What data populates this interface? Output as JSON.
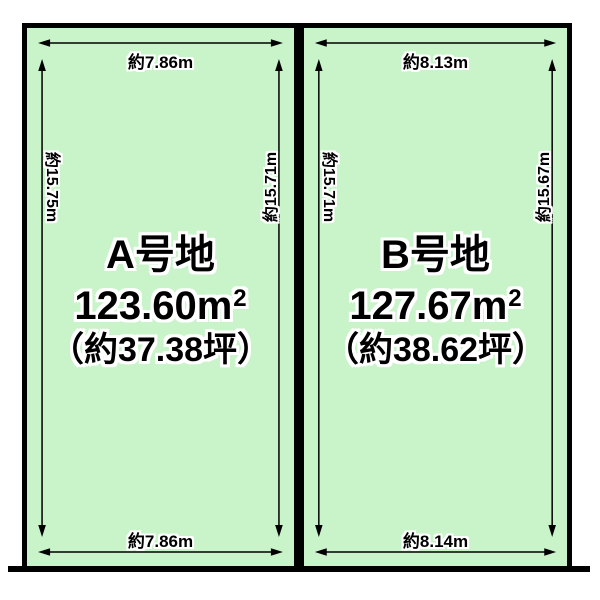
{
  "diagram": {
    "background_color": "#ffffff",
    "plot_fill_color": "#c9f3c9",
    "line_color": "#000000",
    "text_halo_color": "#ffffff"
  },
  "plots": [
    {
      "name": "A号地",
      "area_value": "123.60m",
      "area_sup": "2",
      "tsubo": "（約37.38坪）",
      "dim_top": "約7.86m",
      "dim_bottom": "約7.86m",
      "dim_left": "約15.75m",
      "dim_right": "約15.71m"
    },
    {
      "name": "B号地",
      "area_value": "127.67m",
      "area_sup": "2",
      "tsubo": "（約38.62坪）",
      "dim_top": "約8.13m",
      "dim_bottom": "約8.14m",
      "dim_left": "約15.71m",
      "dim_right": "約15.67m"
    }
  ]
}
